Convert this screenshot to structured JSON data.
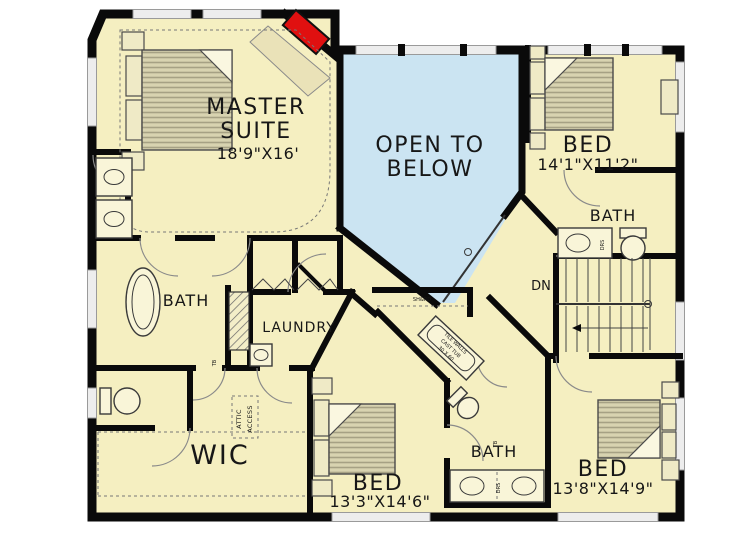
{
  "palette": {
    "floor": "#F5EFC1",
    "open_below": "#CBE4F2",
    "wall": "#0A0A0A",
    "window_fill": "#EDEDED",
    "window_stroke": "#9A9A9A",
    "furniture_fill": "#D8D3B0",
    "furniture_stripe": "#A6A184",
    "fireplace": "#E01010",
    "label": "#171717",
    "railing": "#333333"
  },
  "rooms": {
    "master": {
      "line1": "MASTER",
      "line2": "SUITE",
      "dims": "18'9\"X16'"
    },
    "open_below": {
      "line1": "OPEN TO",
      "line2": "BELOW"
    },
    "bed2": {
      "name": "BED",
      "dims": "14'1\"X11'2\""
    },
    "bath_upper": {
      "name": "BATH"
    },
    "bath_master": {
      "name": "BATH"
    },
    "laundry": {
      "name": "LAUNDRY"
    },
    "wic": {
      "name": "WIC"
    },
    "bed3": {
      "name": "BED",
      "dims": "13'3\"X14'6\""
    },
    "bath_lower": {
      "name": "BATH"
    },
    "bed4": {
      "name": "BED",
      "dims": "13'8\"X14'9\""
    }
  },
  "annotations": {
    "stairs": "DN",
    "attic_line1": "ATTIC",
    "attic_line2": "ACCESS",
    "shelf_rod": "SH&RD",
    "drawers": "DRS",
    "towel_bar": "TB",
    "tub_line1": "TILE WALLS",
    "tub_line2": "CAST TUB",
    "tub_line3": "30 X 60"
  }
}
